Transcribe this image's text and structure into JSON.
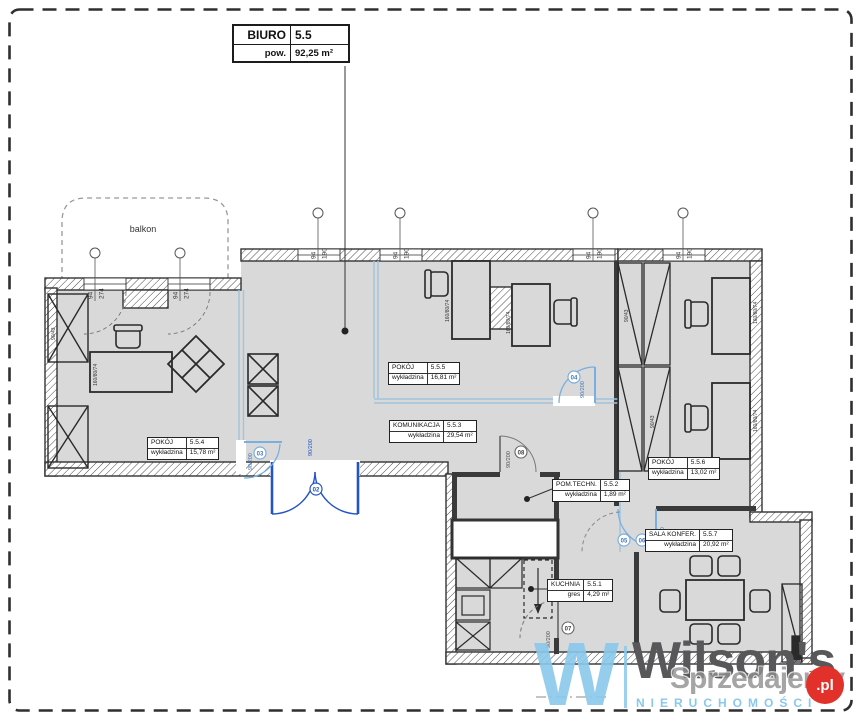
{
  "title_box": {
    "name": "BIURO",
    "number": "5.5",
    "area_label": "pow.",
    "area_value": "92,25 m²"
  },
  "balcony": {
    "label": "balkon"
  },
  "rooms": {
    "r554": {
      "name": "POKÓJ",
      "number": "5.5.4",
      "floor": "wykładzina",
      "area": "15,78 m²"
    },
    "r555": {
      "name": "POKÓJ",
      "number": "5.5.5",
      "floor": "wykładzina",
      "area": "16,81 m²"
    },
    "r553": {
      "name": "KOMUNIKACJA",
      "number": "5.5.3",
      "floor": "wykładzina",
      "area": "29,54 m²"
    },
    "r552": {
      "name": "POM.TECHN.",
      "number": "5.5.2",
      "floor": "wykładzina",
      "area": "1,89 m²"
    },
    "r556": {
      "name": "POKÓJ",
      "number": "5.5.6",
      "floor": "wykładzina",
      "area": "13,02 m²"
    },
    "r557": {
      "name": "SALA KONFER.",
      "number": "5.5.7",
      "floor": "wykładzina",
      "area": "20,92 m²"
    },
    "r551": {
      "name": "KUCHNIA",
      "number": "5.5.1",
      "floor": "gres",
      "area": "4,29 m²"
    }
  },
  "markers": {
    "top": {
      "w": "94",
      "h": "190"
    },
    "left": {
      "w": "94",
      "h": "274"
    }
  },
  "doors": {
    "dims": "90/200",
    "tags": {
      "entrance": "02",
      "room554": "03",
      "room555": "04",
      "room556": "05",
      "conference": "06",
      "kitchen": "07",
      "tech": "08"
    }
  },
  "furniture": {
    "desk_label": "160/80/74",
    "wardrobe_label": "90/43"
  },
  "watermark": {
    "monogram": "W",
    "brand": "Wilson's",
    "subtitle": "NIERUCHOMOŚCI",
    "overlay": "Sprzedajemy",
    "overlay_tld": ".pl"
  },
  "colors": {
    "floor": "#d9d9d9",
    "wall": "#3a3a3a",
    "glass": "#9fc4de",
    "door_main": "#2453c4",
    "door_light": "#7aaede",
    "wm_blue": "#8ac8ec",
    "wm_gray": "#58585a",
    "wm_red": "#e2312a"
  }
}
